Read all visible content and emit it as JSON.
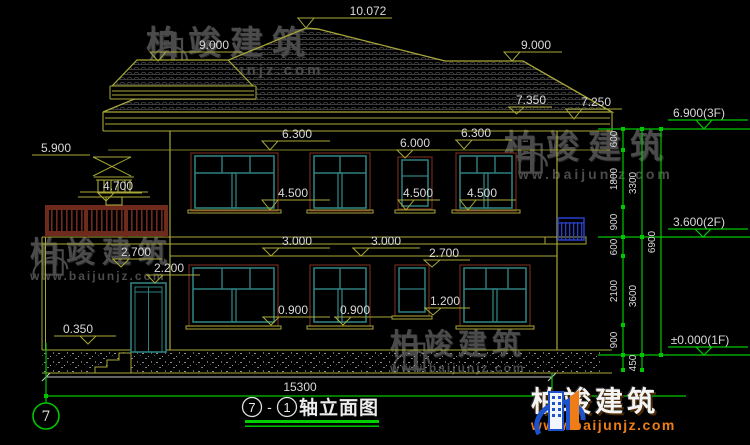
{
  "watermark": {
    "brand": "柏竣建筑",
    "url": "www.baijunjz.com"
  },
  "logo": {
    "brand": "柏竣建筑",
    "url": "www.baijunjz.com"
  },
  "axis": {
    "left_bubble": "7"
  },
  "title": {
    "c1": "7",
    "dash": "-",
    "c2": "1",
    "text": "轴立面图"
  },
  "levels": {
    "ridge": "10.072",
    "ridge_left": "9.000",
    "ridge_right": "9.000",
    "eave_top": "7.350",
    "eave": "7.250",
    "f3": "6.900(3F)",
    "f2": "3.600(2F)",
    "f1": "±0.000(1F)",
    "head_2f_a": "6.300",
    "head_2f_b": "6.300",
    "head_2f_small": "6.000",
    "finial": "5.900",
    "railing": "4.700",
    "sill_2f_a": "4.500",
    "sill_2f_b": "4.500",
    "sill_2f_c": "4.500",
    "band_a": "3.000",
    "band_b": "3.000",
    "head_1f_left": "2.700",
    "head_1f_center": "2.700",
    "door_head": "2.200",
    "sill_1f_small": "1.200",
    "sill_1f_a": "0.900",
    "sill_1f_b": "0.900",
    "porch_floor": "0.350"
  },
  "dimensions": {
    "total_width": "15300",
    "chain1": [
      "600",
      "1800",
      "900",
      "600",
      "2100",
      "900"
    ],
    "chain2": [
      "3300",
      "3600",
      "450"
    ],
    "chain3": [
      "6900"
    ]
  },
  "colors": {
    "background": "#000000",
    "cad_yellow": "#a8a838",
    "cad_teal": "#2e8080",
    "cad_green": "#00c800",
    "cad_red": "#6e2a1c",
    "cad_blue": "#2741cc",
    "dim_text": "#d9d9d9",
    "logo_orange": "#ee7d17",
    "logo_blue": "#1d52cc",
    "watermark_gray": "#4b4b4b"
  }
}
